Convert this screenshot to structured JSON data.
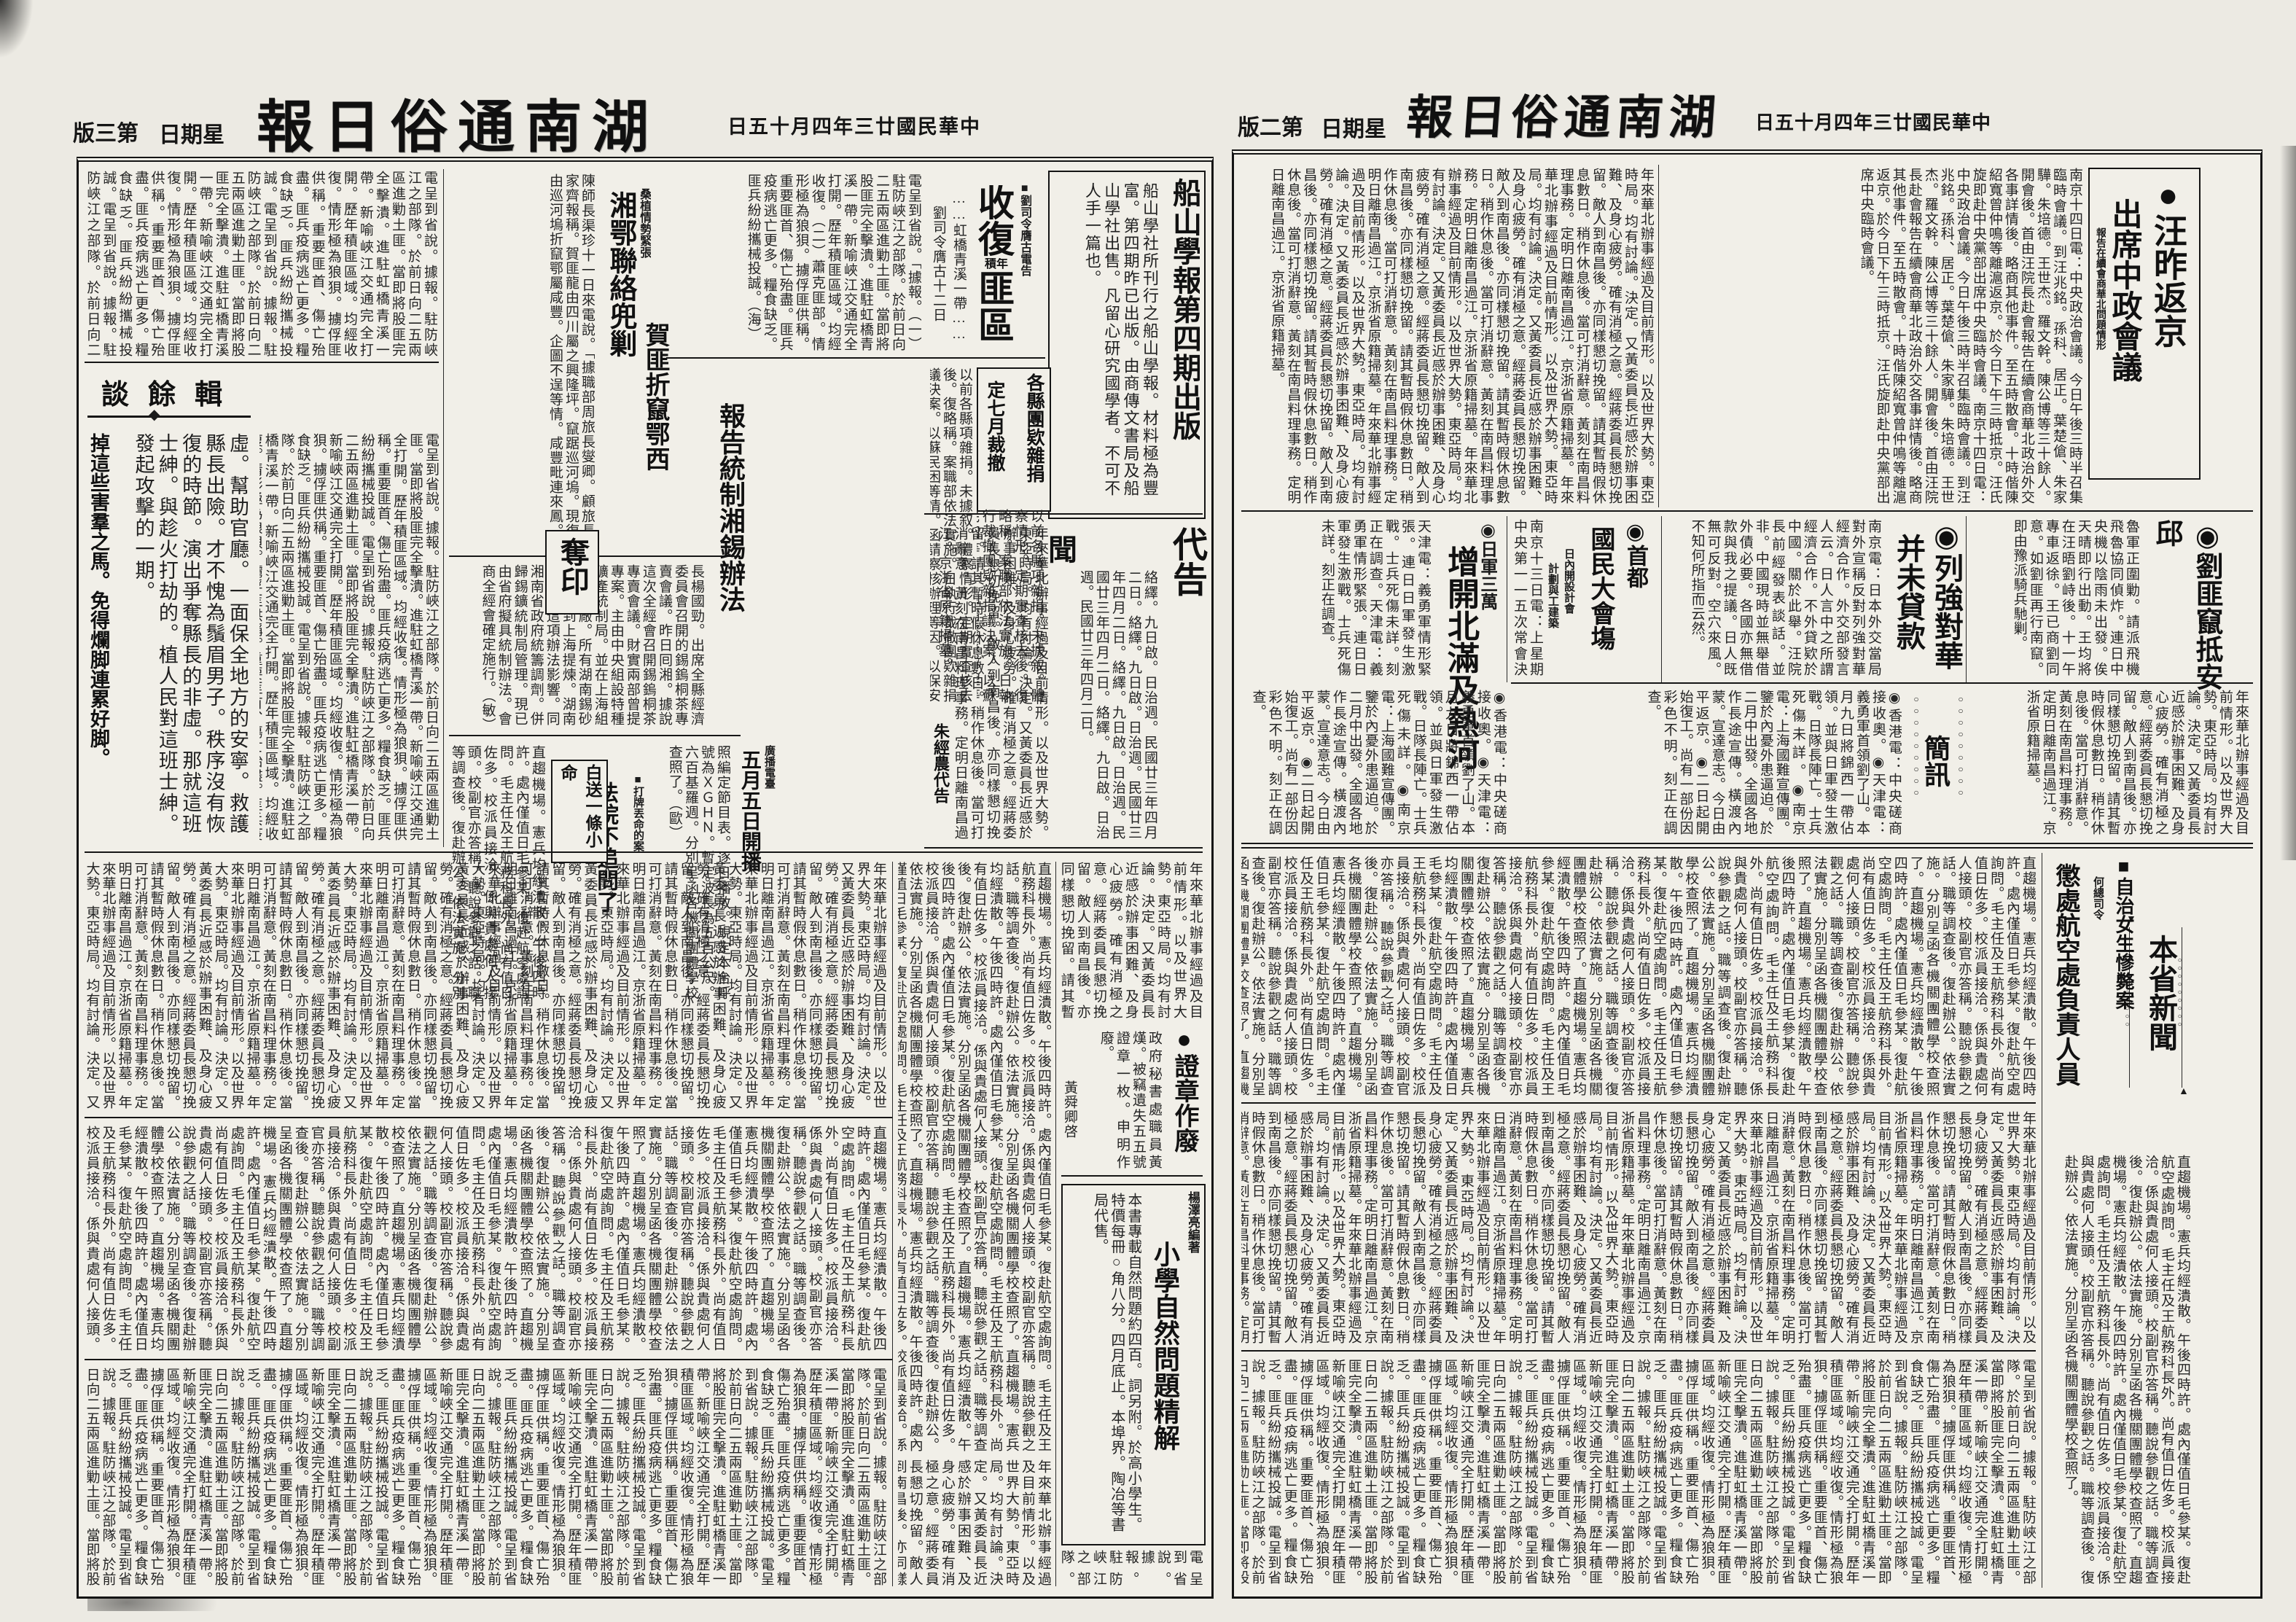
{
  "masthead": {
    "title_display": "報日俗通南湖",
    "date_display": "日五十月四年三廿國民華中",
    "weekday_display": "日期星",
    "page3_label": "版三第",
    "page2_label": "版二第"
  },
  "deco": {
    "dot": "●",
    "ring": "◉",
    "square": "■",
    "chain": "○○○○○○○○○",
    "arrow_up": "▲",
    "arrow_down": "▼",
    "leader": "……"
  },
  "fill": {
    "politics": "年來華北辦事經過及目前情形。以及世界大勢。東亞時局。均有討論。決定。又黃委員長近感於辦事困難、及身心疲勞。確有消極之意。經蔣委員長懇切挽留。敵人到南昌後。亦同樣懇切挽留。請其暫時假休息數日。稍作休息後。當可打消辭意。黃刻在南昌料理事務。定明日離南昌過江。京浙省原籍掃墓。",
    "local": "電呈到省說。據報。駐防峽江之部隊。於前日向二五兩區進勦土匪。當即將股匪完全擊潰。進駐虹橋青溪一帶。新喻峽江交通完全打開。歷年積匪區域。均經收復。情形極為狼狽。擄俘匪供稱。重要匪首、傷亡殆盡。匪兵疫病逃亡更多。糧食缺乏。匪兵紛紛攜械投誠。",
    "city": "直趨機場。憲兵均經潰散。午後四時許。處內僅值日毛參某。復赴航空處詢問。毛主任及王航務科長外。尚有值日佐多。校派員接洽。係與貴處何人接頭。校副官亦答稱。聽說參觀之話。職等調查後。復赴辦公。依法實施。分別呈函各機關團體學校查照了。"
  },
  "page2": {
    "wang": {
      "headline1": "●汪昨返京",
      "headline2": "出席中政會議",
      "kicker": "報告在續會商華北問題情形",
      "body": "南京十四日電：中央政治會議。今日午後三時半召集臨時會議。到汪兆銘。孫科、居正。葉楚傖、朱家驊。朱培德。王世杰。羅文幹。陳公博等三十餘人。開會後。首由汪院長赴會報告在續會商華北政治外交各事詳情後。略商其他事件。至五時散會。十時偕陳紹寬曾仲鳴等離滬返京。於今日下午三時抵京。汪氏旋即赴中央黨部出席中央臨時會議。"
    },
    "liufei": {
      "headline": "◉劉匪竄抵安邱",
      "body": "魯軍正圍勦。請派飛機飛魯協同偵炸。連日中央機以陰雨未出發。俟天晴即行出動。王均將在汪晤劉峙後。十一午專車返徐。王已商劉同意。如劉匪再行南竄。即由豫派騎兵馳剿。"
    },
    "lieqiang": {
      "headline1": "◉列強對華",
      "headline2": "并未貸款",
      "body": "南京電：日本外交當局對外宣稱反對列強對華經濟合作。外交部發言人云。日人言中之所謂經濟合作。不外貸欵於中國。關於此舉。汪院長前經發表談話。並非。中國現時並無舉借外債必要。各國亦無借款與我之提議。日人既無可反對。空穴來風。不知何所指而云然。"
    },
    "shoudu": {
      "headline1": "◉首都",
      "headline2": "國民大會塲",
      "sub1": "日內開設計會",
      "sub2": "計劃與工建築",
      "body": "南京十三日電：上星期中央第一一五次常會決定後。即督同政府趕速興工修備各案。將來決定後分別施行。"
    },
    "rijun": {
      "kicker": "◉日軍三萬",
      "headline": "增開北滿及熱河",
      "body": "天津電：義勇軍情形緊張。連日日軍發生激戰。士兵死傷未詳。刻正在調查。"
    },
    "jianxun": {
      "title": "簡訊",
      "items": "◉香港電：中央磋商接收奧。◉天津電：義勇軍首領劉了山。本月九日將錦西一帶佔領。並與日軍發生激戰。日隊長陣亡。士兵死傷未詳。◉南京電：上海國難宣傳團。鑒於內憂外患逼迫。於二月中出發。全國各地作長途宣傳。橫渡內蒙。宣達意志。今日由平返京。◉二日起開始復工。尚有一部份因彩色不明。刻正在調查。"
    },
    "benxing": {
      "title": "本省新聞",
      "zinu_headline": "■自治女生慘斃案",
      "zinu_kicker": "何總司令",
      "chengchu_headline": "懲處航空處負責人員"
    }
  },
  "page3": {
    "chuanshan": {
      "title": "船山學報第四期出版",
      "body": "船山學社所刊行之船山學報。材料極為豐富。第四期昨已出版。由商傳文書局及船山學社出售。凡留心研究國學者。不可不人手一篇也。"
    },
    "shoufu": {
      "kicker": "■劉司令膺古電告",
      "big1": "收復",
      "small": "積年",
      "big2": "匪區",
      "sub": "……虹橋青溪一帶……",
      "dateline": "劉司令膺古十二日",
      "body": "電呈到省說。「據報。（一）駐防峽江之部隊。於前日向二五兩區進勦土匪。當即將股匪完全擊潰。進駐虹橋青溪一帶。新喻峽江交通完全打開。歷年積匪區域。均經收復。（二）蕭克匪部。情形極為狼狽。擄俘匪供稱。重要匪首、傷亡殆盡。匪兵疫病逃亡更多。糧食缺乏。匪兵紛紛攜械投誠。（海）"
    },
    "hefei": {
      "kicker": "桑植情勢緊張",
      "headline1": "賀匪折竄鄂西",
      "headline2": "湘鄂聯絡兜剿",
      "body": "陳師長渠珍十一日來電說。「據職部周旅長燮卿。顧旅長家齊報稱。賀匪龍由四川屬之興隆坪。竄踞巡河塢。現復由巡河塢折竄鄂屬咸豐。企圖不逞等情。咸豐毗連來鳳。"
    },
    "tuankuan": {
      "box1": "各縣團欵雜捐",
      "box2": "定七月裁撤",
      "body": "以前各縣項雜捐。未據叙。體察情形。定期實查核去後。復略稱。案職部依法實施。日執行裁撤團欵雜捐議決案。以蘇民困等情。函請察核辦理等因。以保安司令部前擬理團欵計劃。關於裁撤。■楊國報。"
    },
    "yutan": {
      "title": "談餘輯",
      "body": "虛。幫助官廳。一面保全地方的安寧。救護縣長出險。才不愧為鬚眉男子。秩序沒有恢復的時節。演出爭奪縣長的非虛。那就這班士紳。與趁火打劫的。植人民對這班士紳。發起攻擊的一期。",
      "closing": "掉這些害羣之馬。免得爛脚連累好脚。"
    },
    "xi": {
      "headline": "報告統制湘錫辦法",
      "body": "長楊國勁。出席全縣經濟委員會召開的錫鎢桐茶專賣會議。昨日囘湘。據說這次全經會召開錫鎢桐茶專賣會議。財實兩部曾提專案。主由中央組設特種礦產統制局。並在上海組設鍊錫廠。所有湖南錫砂都要運到上海提煉。湖南代表因這項辦法影響。同湘南省政府統籌調劑。併歸錫鑛統制局管理。現已由省府擬具統制辦法。會商全經會確定施行。（敏）"
    },
    "duoyin": {
      "title": "奪印"
    },
    "radio": {
      "kicker": "廣播電臺",
      "headline": "五月五日開播",
      "body": "照編定節目表。逐日播放。規定本台呼號為ＸＧＨＮ。暫定波長為五百公尺。六百基羅週。分別呈函各機關團體學校查照了。（歐）"
    },
    "court": {
      "box": "白送一條小命",
      "headline": "法院不追問了",
      "kicker": "■打牌丟命的案"
    },
    "daigao": {
      "title": "代告",
      "big_char": "聞",
      "body": "絡繹。九日啟。日治週。民國廿三年四月二日。",
      "signature": "朱經農代告"
    },
    "zhengzhang": {
      "headline": "●證章作廢",
      "body": "政府秘書處職員黃熯。被竊遺失五五號證章一枚。申明作廢。",
      "signature": "黃舜卿啓"
    },
    "xiaoxue": {
      "author": "楊澤亮編著",
      "title": "小學自然問題精解",
      "body": "本書專載自然問題約四百。詞另附。於高小學生。特價每冊○角八分。四月底止。本埠界。陶冶等書局代售。"
    }
  }
}
